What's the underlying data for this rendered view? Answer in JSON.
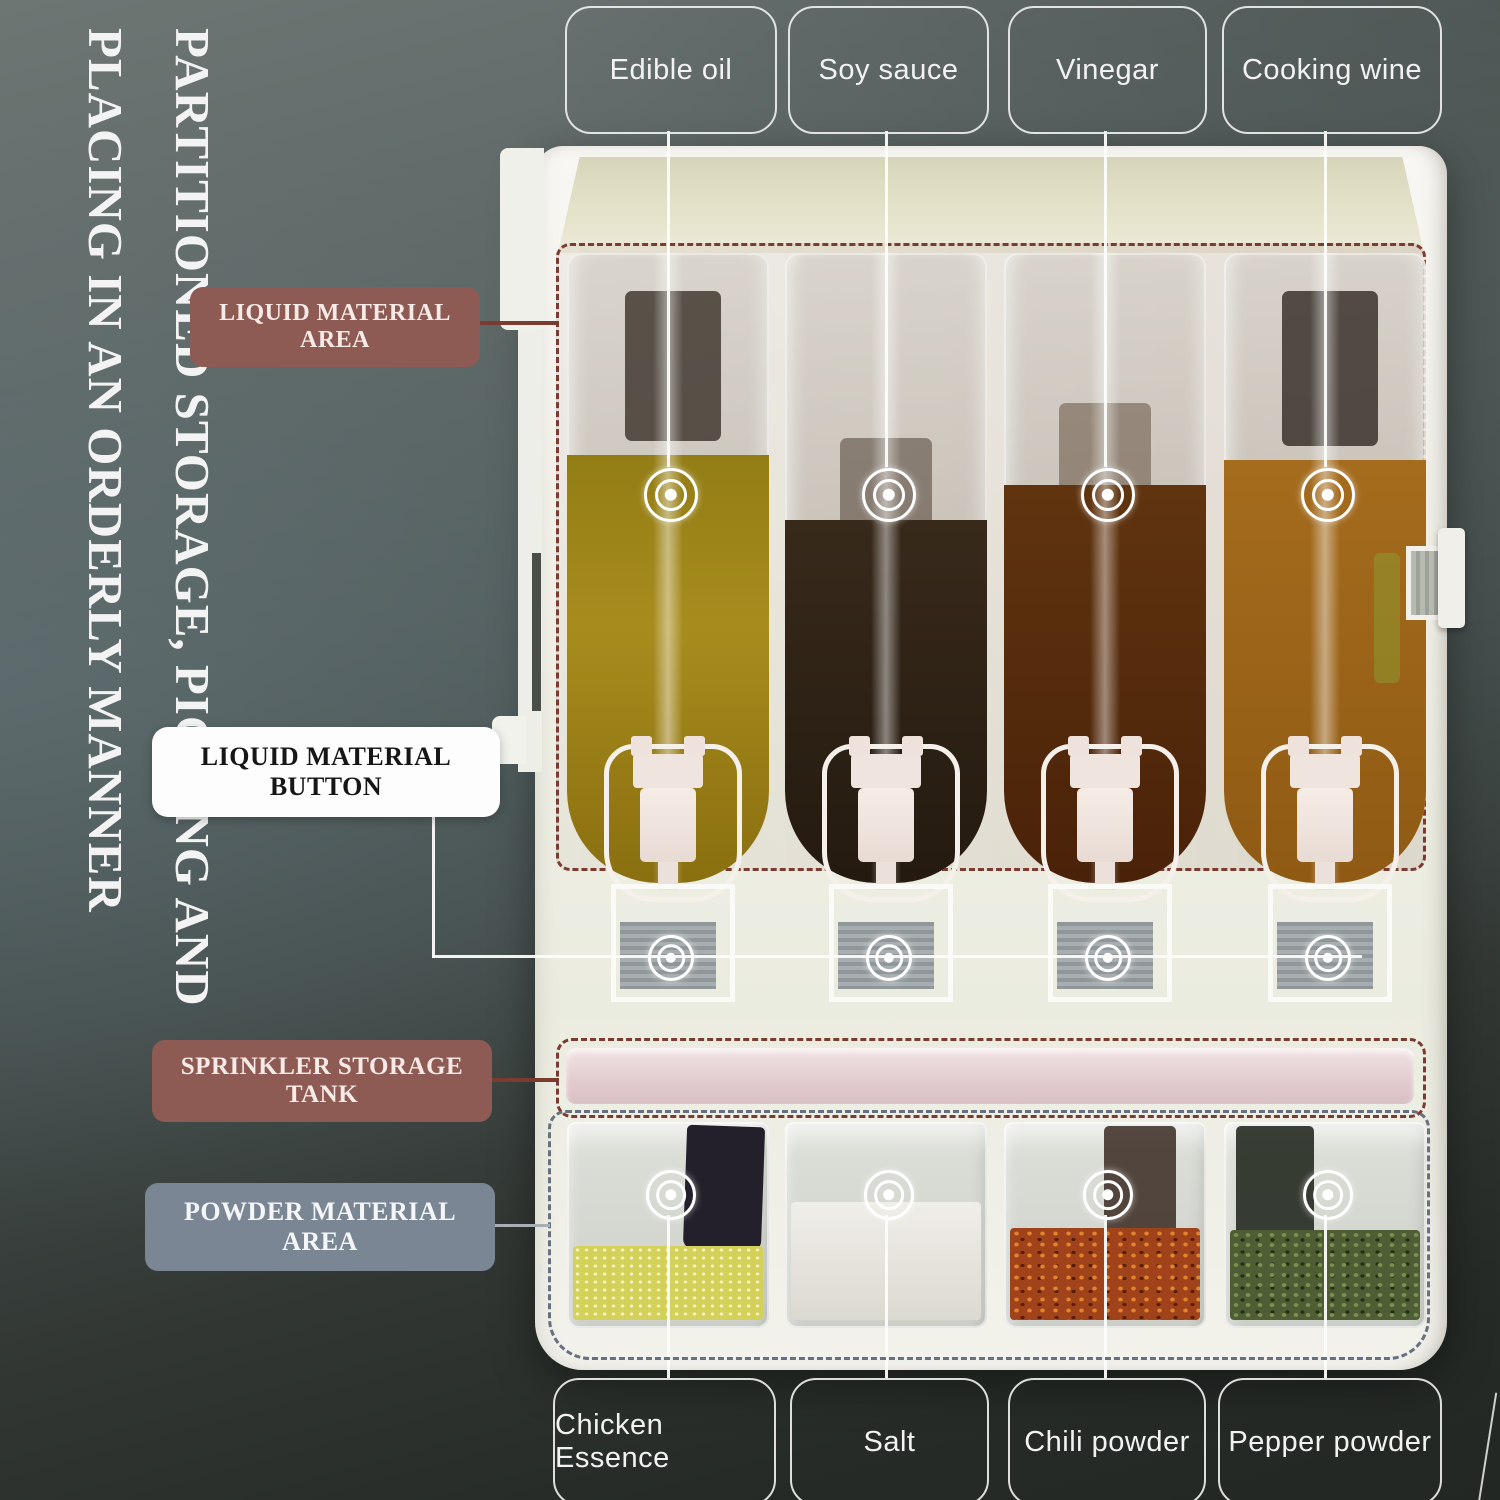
{
  "title": {
    "line1": "PARTITIONED STORAGE, PICKING AND",
    "line2": "PLACING IN AN ORDERLY MANNER"
  },
  "callouts": {
    "liquid_area": {
      "label": "LIQUID MATERIAL AREA",
      "color": "#8d5b53",
      "text_color": "#f7eae7"
    },
    "liquid_button": {
      "label": "LIQUID MATERIAL BUTTON",
      "color": "#fdfdfd",
      "text_color": "#161616"
    },
    "sprinkler_tank": {
      "label": "SPRINKLER STORAGE TANK",
      "color": "#8d5b53",
      "text_color": "#f7eae7"
    },
    "powder_area": {
      "label": "POWDER MATERIAL AREA",
      "color": "#7b8695",
      "text_color": "#f4f6f8"
    }
  },
  "dispenser": {
    "liquid_slots": [
      {
        "label": "Edible oil",
        "liquid_color": "#a78c1d"
      },
      {
        "label": "Soy sauce",
        "liquid_color": "#2f2417"
      },
      {
        "label": "Vinegar",
        "liquid_color": "#552b0c"
      },
      {
        "label": "Cooking wine",
        "liquid_color": "#9d661a"
      }
    ],
    "powder_slots": [
      {
        "label": "Chicken Essence",
        "powder_color": "#d4d15a"
      },
      {
        "label": "Salt",
        "powder_color": "#ece9e3"
      },
      {
        "label": "Chili powder",
        "powder_color": "#a1431a"
      },
      {
        "label": "Pepper powder",
        "powder_color": "#4f5d35"
      }
    ],
    "zone_border_colors": {
      "liquid": "#7c3b31",
      "powder": "#67707e"
    },
    "sprinkler_tank_color": "#e6cfd2",
    "icons": {
      "target": "concentric-circles-target"
    }
  }
}
